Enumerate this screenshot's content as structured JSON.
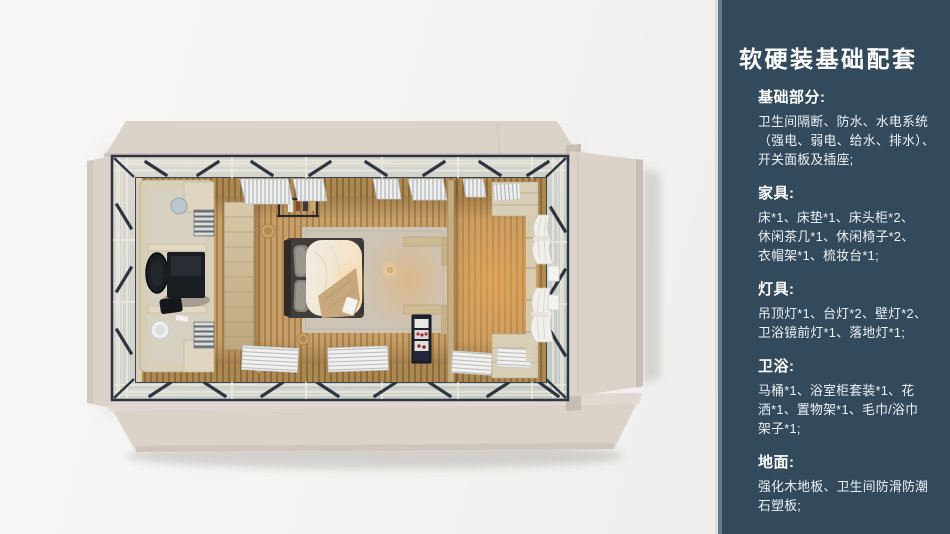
{
  "panel": {
    "title": "软硬装基础配套",
    "sections": [
      {
        "heading": "基础部分:",
        "lines": [
          "卫生间隔断、防水、水电系统",
          "（强电、弱电、给水、排水）、",
          "开关面板及插座;"
        ]
      },
      {
        "heading": "家具:",
        "lines": [
          "床*1、床垫*1、床头柜*2、",
          "休闲茶几*1、休闲椅子*2、",
          "衣帽架*1、梳妆台*1;"
        ]
      },
      {
        "heading": "灯具:",
        "lines": [
          "吊顶灯*1、台灯*2、壁灯*2、",
          "卫浴镜前灯*1、落地灯*1;"
        ]
      },
      {
        "heading": "卫浴:",
        "lines": [
          "马桶*1、浴室柜套装*1、花",
          "洒*1、置物架*1、毛巾/浴巾",
          "架子*1;"
        ]
      },
      {
        "heading": "地面:",
        "lines": [
          "强化木地板、卫生间防滑防潮",
          "石塑板;"
        ]
      }
    ]
  },
  "palette": {
    "bg": "#f4f3f1",
    "panelBg": "#33495c",
    "panelEdgeLight": "#dcdedf",
    "panelEdgeMid": "#647d8e",
    "panelText": "#ffffff",
    "flap": "#dbd2ca",
    "flapShade": "#c7bdb5",
    "frame": "#2e3541",
    "rail": "#efeade",
    "woodWall": "#ad8951",
    "woodDark": "#7c6036",
    "floor": "#c79f66",
    "floorStripe": "#936d41",
    "plywood": "#d9cfb6",
    "rug": "#cdc4b5",
    "bedFrame": "#413d38",
    "duvet": "#f1ece3",
    "pillow": "#86837c",
    "throw": "#c7a87d",
    "black": "#1b1e24",
    "curtain": "#f1efe9",
    "minibar": "#1e2431",
    "white": "#f3f2ef"
  }
}
